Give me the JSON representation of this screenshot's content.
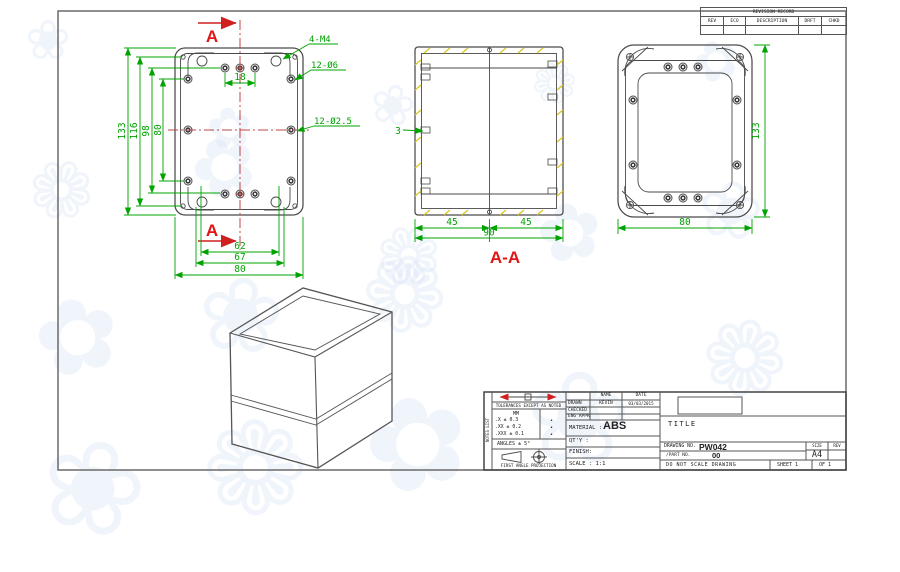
{
  "revision_table": {
    "title": "REVISION RECORD",
    "columns": [
      "REV",
      "ECO",
      "DESCRIPTION",
      "DRFT",
      "CHKD"
    ]
  },
  "front_view": {
    "section_label_top": "A",
    "section_label_bottom": "A",
    "callout_corner": "4-M4",
    "callout_counterbore": "12-Ø6",
    "callout_pilot": "12-Ø2.5",
    "dim_hole_spacing": "18",
    "dim_height_overall": "133",
    "dim_height_116": "116",
    "dim_height_98": "98",
    "dim_height_80": "80",
    "dim_width_62": "62",
    "dim_width_67": "67",
    "dim_width_overall": "80"
  },
  "section_view": {
    "label": "A-A",
    "dim_wall": "3",
    "dim_left": "45",
    "dim_right": "45",
    "dim_overall": "90"
  },
  "back_view": {
    "dim_height": "133",
    "dim_width": "80"
  },
  "title_block": {
    "side_label": "NOTES LIST",
    "tolerance_header": "TOLERANCES EXCEPT AS NOTED",
    "unit_label": "MM",
    "tol_x": ".X ± 0.3",
    "tol_xx": ".XX ± 0.2",
    "tol_xxx": ".XXX ± 0.1",
    "tol_mark": "•",
    "angles": "ANGLES ± 5°",
    "projection_label": "FIRST ANGLE PROJECTION",
    "name_header": "NAME",
    "date_header": "DATE",
    "drawn_label": "DRAWN",
    "drawn_name": "KEVIN",
    "drawn_date": "03/03/2015",
    "checked_label": "CHECKED",
    "eng_appr_label": "ENG APPR",
    "material_label": "MATERIAL :",
    "material_value": "ABS",
    "qty_label": "QT'Y :",
    "finish_label": "FINISH:",
    "scale_label": "SCALE : 1:1",
    "title_label": "TITLE",
    "drawing_no_label": "DRAWING NO.",
    "drawing_no": "PW042",
    "part_no_label": "/PART NO.",
    "part_no": "00",
    "size_label": "SIZE",
    "size_value": "A4",
    "rev_label": "REV",
    "do_not_scale": "DO NOT SCALE DRAWING",
    "sheet_label": "SHEET 1",
    "of_label": "OF 1"
  },
  "watermark": {
    "glyphs": [
      "❀",
      "✿",
      "❁"
    ],
    "color": "#dfe7f8"
  }
}
